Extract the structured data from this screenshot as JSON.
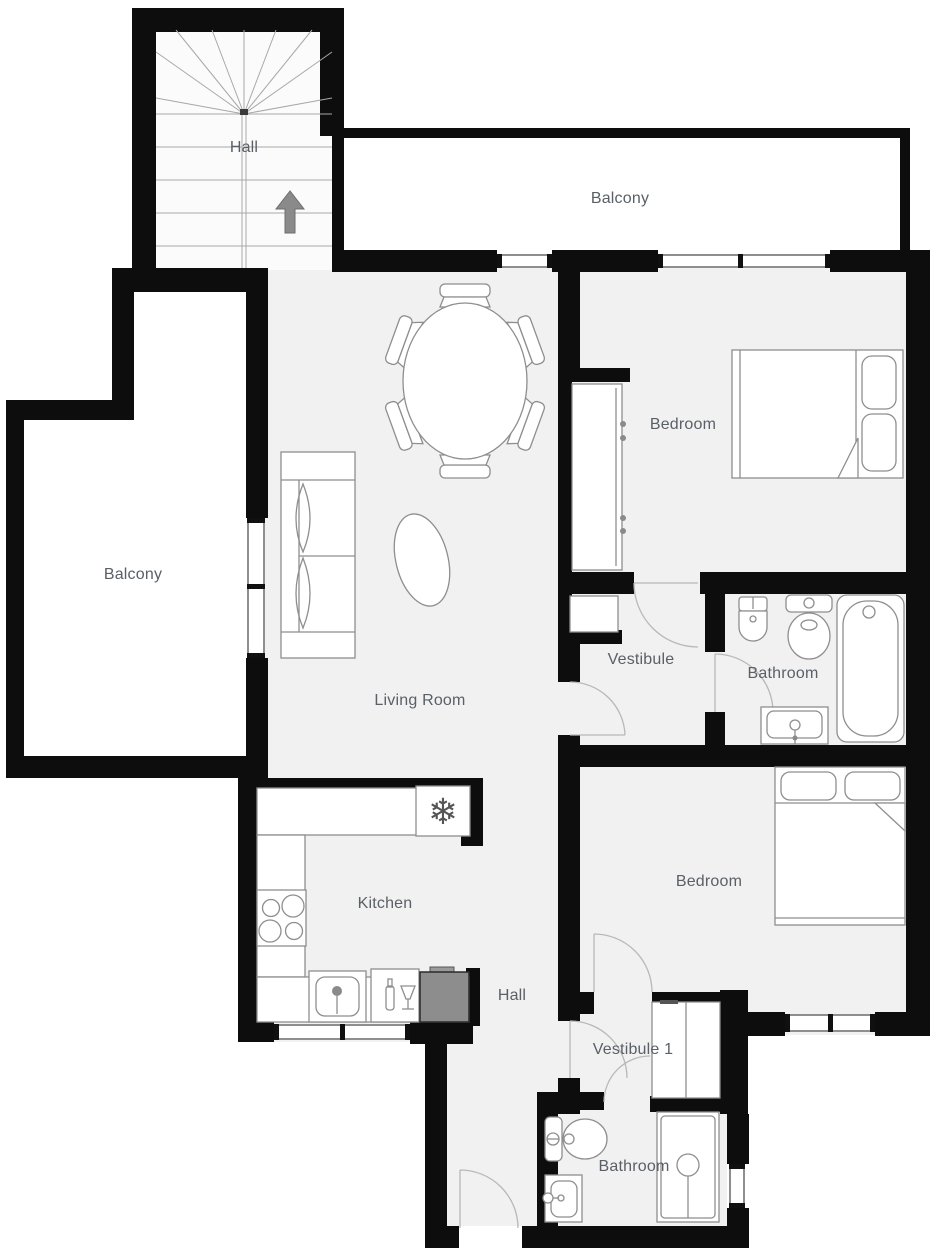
{
  "title": "Apartment floor plan",
  "palette": {
    "wall": "#0d0d0d",
    "floor": "#f1f1f2",
    "furniture_outline": "#8e8e8e",
    "label": "#5a6066",
    "appliance_dark": "#8d8d8d",
    "door_arc": "#b8b8b8",
    "window_line": "#8e8e8e"
  },
  "rooms": [
    {
      "name": "hall-stairs",
      "label": "Hall"
    },
    {
      "name": "balcony-top",
      "label": "Balcony"
    },
    {
      "name": "bedroom-1",
      "label": "Bedroom"
    },
    {
      "name": "balcony-left",
      "label": "Balcony"
    },
    {
      "name": "vestibule",
      "label": "Vestibule"
    },
    {
      "name": "bathroom-1",
      "label": "Bathroom"
    },
    {
      "name": "living-room",
      "label": "Living Room"
    },
    {
      "name": "kitchen",
      "label": "Kitchen"
    },
    {
      "name": "hall-lower",
      "label": "Hall"
    },
    {
      "name": "bedroom-2",
      "label": "Bedroom"
    },
    {
      "name": "vestibule-1",
      "label": "Vestibule 1"
    },
    {
      "name": "bathroom-2",
      "label": "Bathroom"
    }
  ],
  "icons": {
    "stairs_direction_arrow": "up",
    "fridge_icon": "snowflake",
    "dishwasher_icon": "bottle-and-glass"
  },
  "furniture": [
    "staircase-with-winders",
    "dining-table-oval-6-chairs",
    "sofa-2-seat",
    "rug-oval",
    "wardrobe",
    "vestibule-cabinet",
    "double-bed-1",
    "double-bed-2",
    "bidet",
    "toilet-1",
    "bathtub",
    "bathroom-sink-1",
    "toilet-2",
    "bathroom-sink-2",
    "shower-cabin",
    "closet",
    "kitchen-counter",
    "fridge",
    "stove-4-burner",
    "kitchen-sink",
    "dishwasher",
    "dark-appliance"
  ]
}
